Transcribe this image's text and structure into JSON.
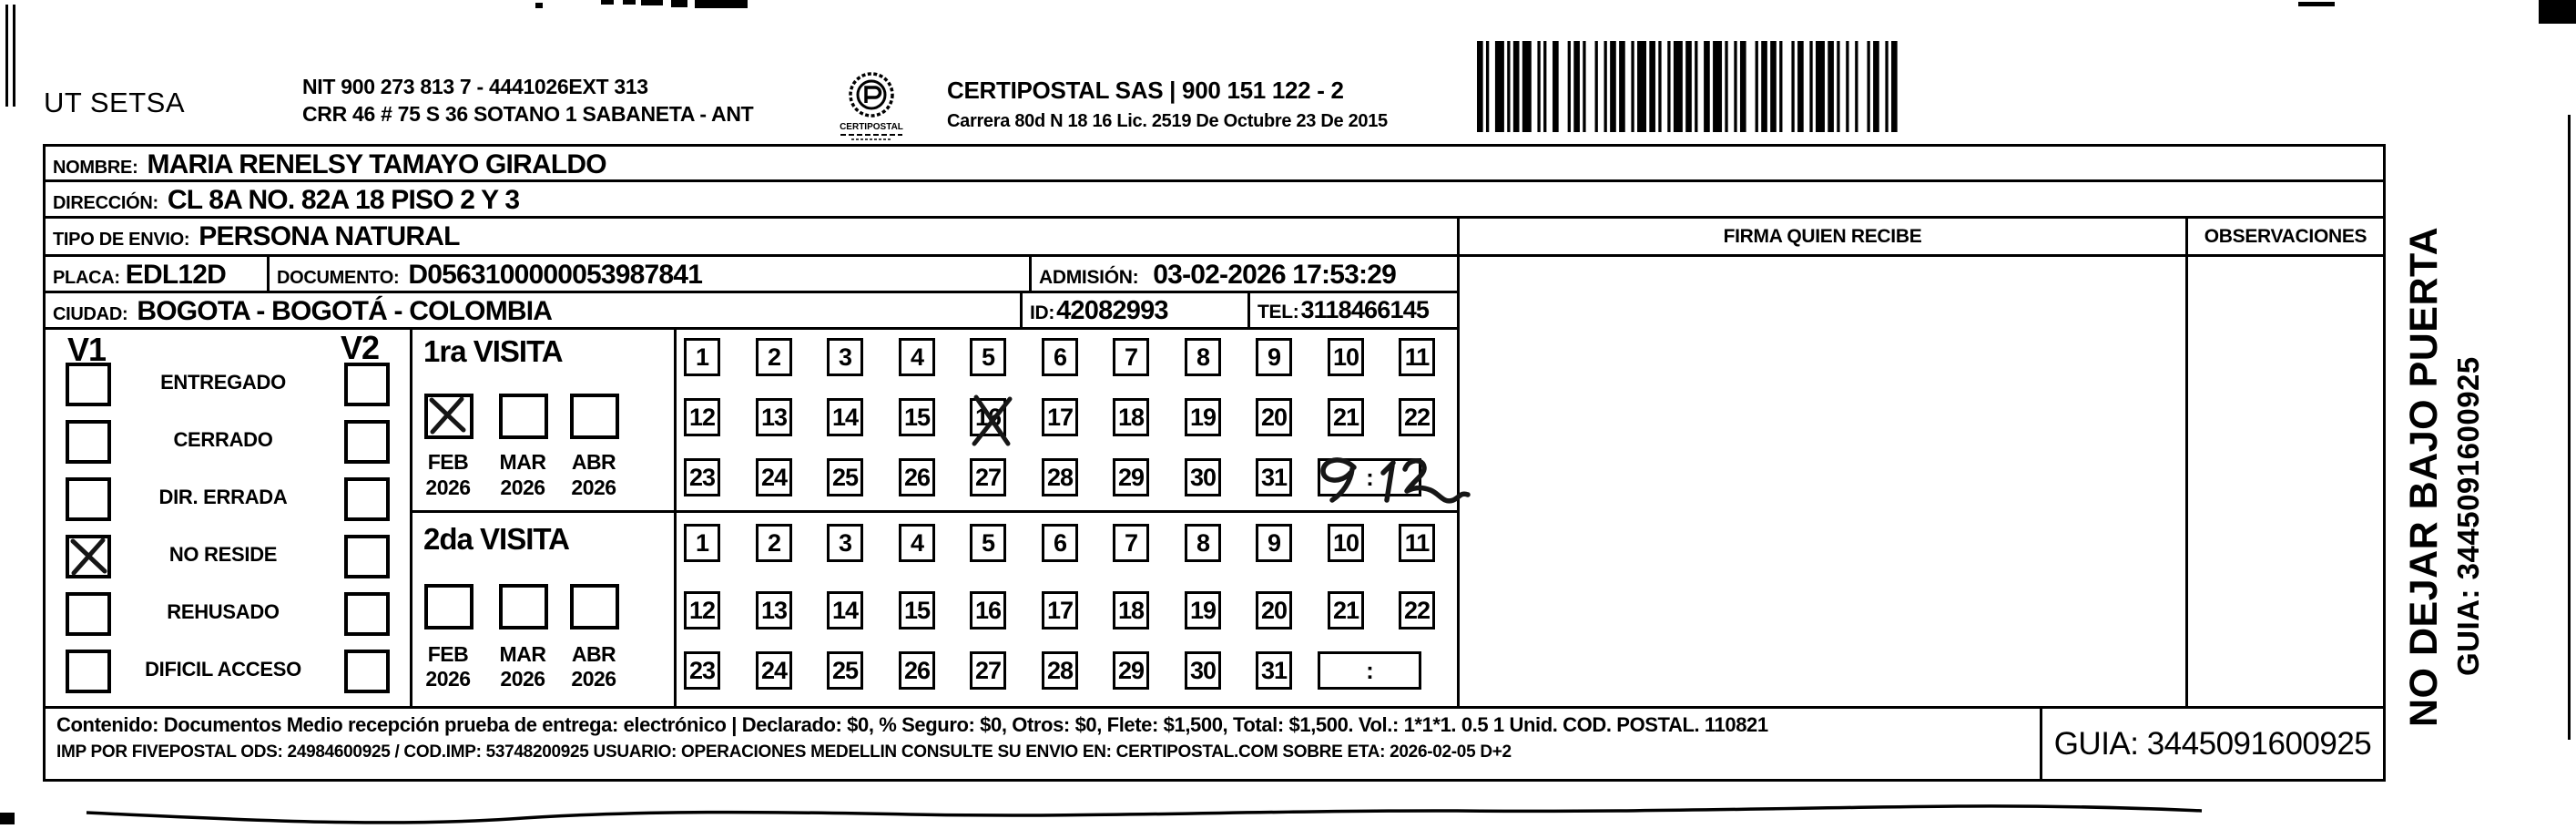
{
  "header": {
    "company": "UT SETSA",
    "nit_line1": "NIT 900 273 813 7 - 4441026EXT 313",
    "nit_line2": "CRR 46 # 75 S 36 SOTANO 1 SABANETA - ANT",
    "logo_text": "CERTIPOSTAL",
    "provider_line1": "CERTIPOSTAL SAS | 900 151 122 - 2",
    "provider_line2": "Carrera 80d N 18 16  Lic. 2519 De Octubre 23 De 2015"
  },
  "recipient": {
    "nombre_label": "NOMBRE:",
    "nombre": "MARIA RENELSY TAMAYO GIRALDO",
    "direccion_label": "DIRECCIÓN:",
    "direccion": "CL 8A NO. 82A 18 PISO 2 Y 3",
    "tipo_label": "TIPO DE ENVIO:",
    "tipo": "PERSONA NATURAL",
    "placa_label": "PLACA:",
    "placa": "EDL12D",
    "documento_label": "DOCUMENTO:",
    "documento": "D0563100000053987841",
    "admision_label": "ADMISIÓN:",
    "admision": "03-02-2026 17:53:29",
    "ciudad_label": "CIUDAD:",
    "ciudad": "BOGOTA - BOGOTÁ - COLOMBIA",
    "id_label": "ID:",
    "id_value": "42082993",
    "tel_label": "TEL:",
    "tel": "3118466145"
  },
  "columns": {
    "firma": "FIRMA QUIEN RECIBE",
    "observaciones": "OBSERVACIONES"
  },
  "status": {
    "v1_label": "V1",
    "v2_label": "V2",
    "options": [
      {
        "label": "ENTREGADO",
        "v1": false,
        "v2": false
      },
      {
        "label": "CERRADO",
        "v1": false,
        "v2": false
      },
      {
        "label": "DIR. ERRADA",
        "v1": false,
        "v2": false
      },
      {
        "label": "NO RESIDE",
        "v1": true,
        "v2": false
      },
      {
        "label": "REHUSADO",
        "v1": false,
        "v2": false
      },
      {
        "label": "DIFICIL ACCESO",
        "v1": false,
        "v2": false
      }
    ]
  },
  "visits": {
    "first": {
      "title": "1ra VISITA",
      "months": [
        {
          "month": "FEB",
          "year": "2026",
          "checked": true
        },
        {
          "month": "MAR",
          "year": "2026",
          "checked": false
        },
        {
          "month": "ABR",
          "year": "2026",
          "checked": false
        }
      ],
      "day_rows": [
        [
          "1",
          "2",
          "3",
          "4",
          "5",
          "6",
          "7",
          "8",
          "9",
          "10",
          "11"
        ],
        [
          "12",
          "13",
          "14",
          "15",
          "16",
          "17",
          "18",
          "19",
          "20",
          "21",
          "22"
        ],
        [
          "23",
          "24",
          "25",
          "26",
          "27",
          "28",
          "29",
          "30",
          "31"
        ]
      ],
      "crossed_day": "16",
      "time_box": ":",
      "handwritten_time": "9:12"
    },
    "second": {
      "title": "2da VISITA",
      "months": [
        {
          "month": "FEB",
          "year": "2026",
          "checked": false
        },
        {
          "month": "MAR",
          "year": "2026",
          "checked": false
        },
        {
          "month": "ABR",
          "year": "2026",
          "checked": false
        }
      ],
      "day_rows": [
        [
          "1",
          "2",
          "3",
          "4",
          "5",
          "6",
          "7",
          "8",
          "9",
          "10",
          "11"
        ],
        [
          "12",
          "13",
          "14",
          "15",
          "16",
          "17",
          "18",
          "19",
          "20",
          "21",
          "22"
        ],
        [
          "23",
          "24",
          "25",
          "26",
          "27",
          "28",
          "29",
          "30",
          "31"
        ]
      ],
      "crossed_day": null,
      "time_box": ":",
      "handwritten_time": null
    }
  },
  "footer": {
    "line1": "Contenido: Documentos Medio recepción prueba de entrega: electrónico | Declarado: $0, % Seguro: $0, Otros: $0, Flete: $1,500, Total: $1,500. Vol.: 1*1*1. 0.5 1 Unid. COD. POSTAL. 110821",
    "line2": "IMP POR FIVEPOSTAL ODS: 24984600925 / COD.IMP: 53748200925 USUARIO: OPERACIONES MEDELLIN CONSULTE SU ENVIO EN: CERTIPOSTAL.COM SOBRE ETA: 2026-02-05 D+2",
    "guia": "GUIA: 3445091600925"
  },
  "side_note": {
    "line1": "NO DEJAR BAJO PUERTA",
    "line2": "GUIA: 3445091600925"
  }
}
